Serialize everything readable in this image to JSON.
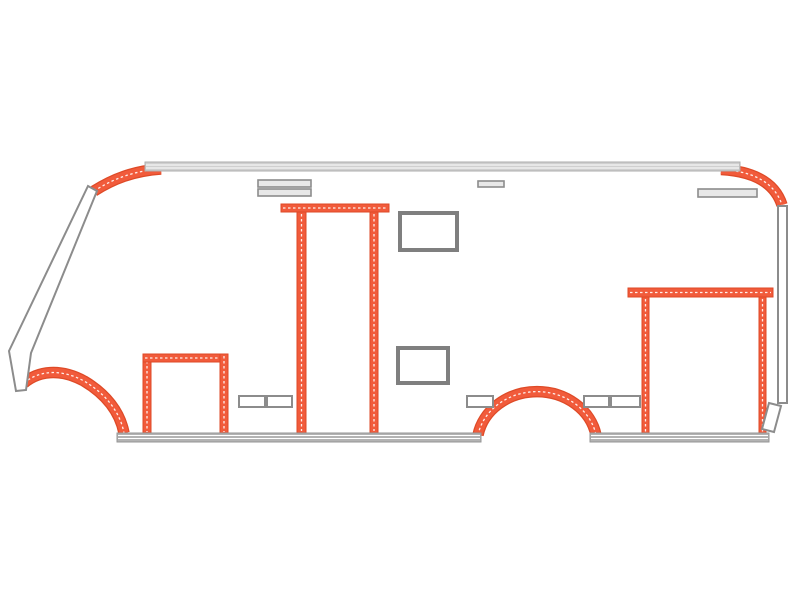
{
  "diagram": {
    "kind": "vehicle-side-profile-schematic",
    "canvas": {
      "width": 800,
      "height": 601,
      "background": "#ffffff"
    },
    "palette": {
      "accent": "#F15B3B",
      "accent_edge": "#DE4A27",
      "accent_dash": "#FFFFFF",
      "outline": "#8C8C8C",
      "outline_dark": "#7F7F7F",
      "panel_fill": "#FFFFFF",
      "vent_fill": "#E8E8E8",
      "rail_light_fill": "#CFCFCF",
      "rail_light_edge": "#AEAEAE",
      "rail_dark_fill": "#B3B3B3",
      "rail_dark_edge": "#969696",
      "rail_stripe": "#FFFFFF"
    },
    "parts": [
      {
        "name": "front-roof-corner-trim",
        "type": "opath",
        "interactable": true,
        "d": "M 94 191 C 113 179 133 171 161 169",
        "w": 9
      },
      {
        "name": "rear-roof-corner-trim",
        "type": "opath",
        "interactable": true,
        "d": "M 721 169.5 C 749 171 774 180 782 205",
        "w": 9
      },
      {
        "name": "front-wheel-arch-trim",
        "type": "opath",
        "interactable": true,
        "d": "M 24 383 C 38 371 60 368 84 381 C 106 394 120 412 124 433",
        "w": 9
      },
      {
        "name": "rear-wheel-arch-trim",
        "type": "opath",
        "interactable": true,
        "d": "M 478 435 A 60 53 0 0 1 596 435",
        "w": 9
      },
      {
        "name": "entry-door-frame-left-post",
        "type": "obar",
        "interactable": true,
        "x": 143,
        "y": 354,
        "w": 8,
        "h": 80
      },
      {
        "name": "entry-door-frame-header",
        "type": "obar",
        "interactable": true,
        "x": 143,
        "y": 354,
        "w": 85,
        "h": 8
      },
      {
        "name": "entry-door-frame-right-post",
        "type": "obar",
        "interactable": true,
        "x": 220,
        "y": 354,
        "w": 8,
        "h": 80
      },
      {
        "name": "mid-door-frame-header",
        "type": "obar",
        "interactable": true,
        "x": 281,
        "y": 204,
        "w": 108,
        "h": 8
      },
      {
        "name": "mid-door-frame-left-post",
        "type": "obar",
        "interactable": true,
        "x": 297,
        "y": 212,
        "w": 9,
        "h": 221
      },
      {
        "name": "mid-door-frame-right-post",
        "type": "obar",
        "interactable": true,
        "x": 370,
        "y": 212,
        "w": 8,
        "h": 221
      },
      {
        "name": "rear-garage-frame-header",
        "type": "obar",
        "interactable": true,
        "x": 628,
        "y": 288,
        "w": 145,
        "h": 9
      },
      {
        "name": "rear-garage-frame-left-post",
        "type": "obar",
        "interactable": true,
        "x": 642,
        "y": 297,
        "w": 7,
        "h": 137
      },
      {
        "name": "rear-garage-frame-right-post",
        "type": "obar",
        "interactable": true,
        "x": 759,
        "y": 297,
        "w": 7,
        "h": 137
      },
      {
        "name": "roof-rail",
        "type": "rail",
        "interactable": false,
        "x": 145,
        "y": 162,
        "w": 595,
        "h": 9,
        "fill": "rail_light_fill",
        "edge": "rail_light_edge",
        "lines": [
          3,
          6
        ]
      },
      {
        "name": "skirt-rail-front",
        "type": "rail",
        "interactable": false,
        "x": 117,
        "y": 433,
        "w": 364,
        "h": 9,
        "fill": "rail_dark_fill",
        "edge": "rail_dark_edge",
        "lines": [
          2.5,
          5.5
        ]
      },
      {
        "name": "skirt-rail-rear",
        "type": "rail",
        "interactable": false,
        "x": 590,
        "y": 433,
        "w": 179,
        "h": 9,
        "fill": "rail_dark_fill",
        "edge": "rail_dark_edge",
        "lines": [
          2.5,
          5.5
        ]
      },
      {
        "name": "windshield-pillar",
        "type": "poly",
        "interactable": false,
        "points": "88,186 97,191 31,353 26,390 16,391 9,351"
      },
      {
        "name": "rear-corner-pillar",
        "type": "rect",
        "interactable": false,
        "x": 778,
        "y": 206,
        "w": 9,
        "h": 197,
        "fill": "panel_fill",
        "stroke": "outline",
        "sw": 2
      },
      {
        "name": "rear-corner-skid",
        "type": "poly",
        "interactable": false,
        "points": "769,403 781,406 774,432 762,429"
      },
      {
        "name": "roof-vent-slat-upper",
        "type": "rect",
        "interactable": false,
        "x": 258,
        "y": 180,
        "w": 53,
        "h": 7,
        "fill": "vent_fill",
        "stroke": "outline",
        "sw": 1.6
      },
      {
        "name": "roof-vent-slat-lower",
        "type": "rect",
        "interactable": false,
        "x": 258,
        "y": 189,
        "w": 53,
        "h": 7,
        "fill": "vent_fill",
        "stroke": "outline",
        "sw": 1.6
      },
      {
        "name": "roof-vent-small",
        "type": "rect",
        "interactable": false,
        "x": 478,
        "y": 181,
        "w": 26,
        "h": 6,
        "fill": "vent_fill",
        "stroke": "outline",
        "sw": 1.6
      },
      {
        "name": "rear-roof-vent",
        "type": "rect",
        "interactable": false,
        "x": 698,
        "y": 189,
        "w": 59,
        "h": 8,
        "fill": "vent_fill",
        "stroke": "outline",
        "sw": 1.6
      },
      {
        "name": "upper-window",
        "type": "rect",
        "interactable": false,
        "x": 400,
        "y": 213,
        "w": 57,
        "h": 37,
        "fill": "panel_fill",
        "stroke": "outline_dark",
        "sw": 4
      },
      {
        "name": "lower-window",
        "type": "rect",
        "interactable": false,
        "x": 398,
        "y": 348,
        "w": 50,
        "h": 35,
        "fill": "panel_fill",
        "stroke": "outline_dark",
        "sw": 4
      },
      {
        "name": "service-hatch-1",
        "type": "rect",
        "interactable": false,
        "x": 239,
        "y": 396,
        "w": 26,
        "h": 11,
        "fill": "panel_fill",
        "stroke": "outline",
        "sw": 2
      },
      {
        "name": "service-hatch-2",
        "type": "rect",
        "interactable": false,
        "x": 267,
        "y": 396,
        "w": 25,
        "h": 11,
        "fill": "panel_fill",
        "stroke": "outline",
        "sw": 2
      },
      {
        "name": "service-hatch-3",
        "type": "rect",
        "interactable": false,
        "x": 467,
        "y": 396,
        "w": 26,
        "h": 11,
        "fill": "panel_fill",
        "stroke": "outline",
        "sw": 2
      },
      {
        "name": "service-hatch-4",
        "type": "rect",
        "interactable": false,
        "x": 584,
        "y": 396,
        "w": 25,
        "h": 11,
        "fill": "panel_fill",
        "stroke": "outline",
        "sw": 2
      },
      {
        "name": "service-hatch-5",
        "type": "rect",
        "interactable": false,
        "x": 611,
        "y": 396,
        "w": 29,
        "h": 11,
        "fill": "panel_fill",
        "stroke": "outline",
        "sw": 2
      }
    ]
  }
}
